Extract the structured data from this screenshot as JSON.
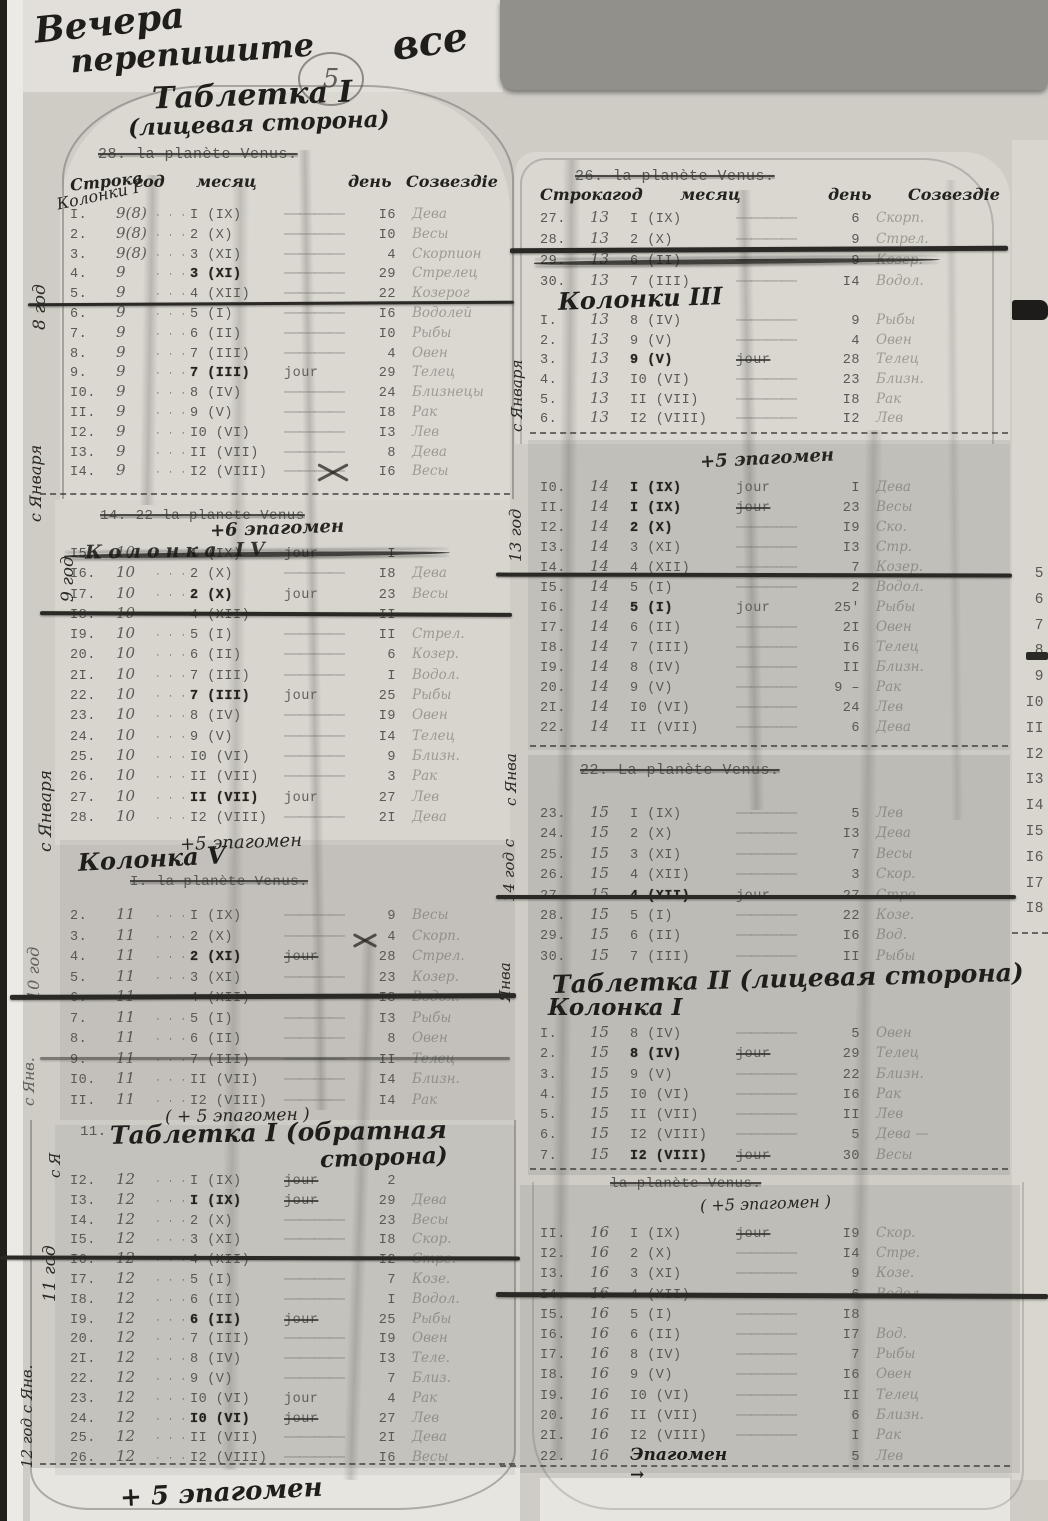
{
  "misc": {
    "dots": "· · ·",
    "dash": "――――",
    "jour": "jour"
  },
  "annotations": {
    "top_scribble_1": "Вечера",
    "top_scribble_2": "перепишите",
    "top_scribble_3": "все",
    "circled_mark": "5",
    "bottom_note": "+ 5 эпагомен"
  },
  "left": {
    "title": "Таблетка I",
    "subtitle": "(лицевая сторона)",
    "t1": {
      "struck_header": "28.      la planète Venus.",
      "headers": {
        "row": "Строка",
        "year": "год",
        "month": "месяц",
        "day": "день",
        "constellation": "Созвездiе"
      },
      "margin_block": "Колонки I",
      "margin_year": "8 год",
      "margin_start": "с Января",
      "rows": [
        {
          "n": "I.",
          "y": "9(8)",
          "m": "I (IX)",
          "d": "I6",
          "c": "Дева"
        },
        {
          "n": "2.",
          "y": "9(8)",
          "m": "2 (X)",
          "d": "I0",
          "c": "Весы"
        },
        {
          "n": "3.",
          "y": "9(8)",
          "m": "3 (XI)",
          "d": "4",
          "c": "Скорпион"
        },
        {
          "n": "4.",
          "y": "9",
          "m": "3 (XI)",
          "b": 1,
          "d": "29",
          "c": "Стрелец"
        },
        {
          "n": "5.",
          "y": "9",
          "m": "4 (XII)",
          "d": "22",
          "c": "Козерог"
        },
        {
          "n": "6.",
          "y": "9",
          "m": "5 (I)",
          "d": "I6",
          "c": "Водолей"
        },
        {
          "n": "7.",
          "y": "9",
          "m": "6 (II)",
          "d": "I0",
          "c": "Рыбы"
        },
        {
          "n": "8.",
          "y": "9",
          "m": "7 (III)",
          "d": "4",
          "c": "Овен"
        },
        {
          "n": "9.",
          "y": "9",
          "m": "7 (III)",
          "b": 1,
          "j": "j",
          "d": "29",
          "c": "Телец"
        },
        {
          "n": "I0.",
          "y": "9",
          "m": "8 (IV)",
          "d": "24",
          "c": "Близнецы"
        },
        {
          "n": "II.",
          "y": "9",
          "m": "9 (V)",
          "d": "I8",
          "c": "Рак"
        },
        {
          "n": "I2.",
          "y": "9",
          "m": "I0 (VI)",
          "d": "I3",
          "c": "Лев"
        },
        {
          "n": "I3.",
          "y": "9",
          "m": "II (VII)",
          "d": "8",
          "c": "Дева"
        },
        {
          "n": "I4.",
          "y": "9",
          "m": "I2 (VIII)",
          "d": "I6",
          "c": "Весы"
        }
      ]
    },
    "t2": {
      "struck_header": "14.  22  la planete Venus",
      "note": "+6 эпагомен",
      "row15_overwrite": "Колонка IV",
      "margin_year": "9 год",
      "margin_start": "с Января",
      "footer": "+5 эпагомен",
      "rows": [
        {
          "n": "I5.",
          "y": "10",
          "m": "I (IX)",
          "j": "j",
          "d": "I",
          "s": 1,
          "c": ""
        },
        {
          "n": "I6.",
          "y": "10",
          "m": "2 (X)",
          "d": "I8",
          "c": "Дева"
        },
        {
          "n": "I7.",
          "y": "10",
          "m": "2 (X)",
          "b": 1,
          "j": "j",
          "d": "23",
          "c": "Весы"
        },
        {
          "n": "I8.",
          "y": "10",
          "m": "4 (XII)",
          "d": "II",
          "c": ""
        },
        {
          "n": "I9.",
          "y": "10",
          "m": "5 (I)",
          "d": "II",
          "c": "Стрел."
        },
        {
          "n": "20.",
          "y": "10",
          "m": "6 (II)",
          "d": "6",
          "c": "Козер."
        },
        {
          "n": "2I.",
          "y": "10",
          "m": "7 (III)",
          "d": "I",
          "c": "Водол."
        },
        {
          "n": "22.",
          "y": "10",
          "m": "7 (III)",
          "b": 1,
          "j": "j",
          "d": "25",
          "c": "Рыбы"
        },
        {
          "n": "23.",
          "y": "10",
          "m": "8 (IV)",
          "d": "I9",
          "c": "Овен"
        },
        {
          "n": "24.",
          "y": "10",
          "m": "9 (V)",
          "d": "I4",
          "c": "Телец"
        },
        {
          "n": "25.",
          "y": "10",
          "m": "I0 (VI)",
          "d": "9",
          "c": "Близн."
        },
        {
          "n": "26.",
          "y": "10",
          "m": "II (VII)",
          "d": "3",
          "c": "Рак"
        },
        {
          "n": "27.",
          "y": "10",
          "m": "II (VII)",
          "b": 1,
          "j": "j",
          "d": "27",
          "c": "Лев"
        },
        {
          "n": "28.",
          "y": "10",
          "m": "I2 (VIII)",
          "d": "2I",
          "c": "Дева"
        }
      ]
    },
    "t3": {
      "heading": "Колонка V",
      "struck_header": "I.      la planète Venus.",
      "margin_year": "10 год",
      "margin_start": "с Янв.",
      "footer": "( + 5 эпагомен )",
      "rows": [
        {
          "n": "2.",
          "y": "11",
          "m": "I (IX)",
          "d": "9",
          "c": "Весы"
        },
        {
          "n": "3.",
          "y": "11",
          "m": "2 (X)",
          "d": "4",
          "c": "Скорп."
        },
        {
          "n": "4.",
          "y": "11",
          "m": "2 (XI)",
          "b": 1,
          "j": "js",
          "d": "28",
          "c": "Стрел."
        },
        {
          "n": "5.",
          "y": "11",
          "m": "3 (XI)",
          "d": "23",
          "c": "Козер."
        },
        {
          "n": "6.",
          "y": "11",
          "m": "4 (XII)",
          "d": "I8",
          "c": "Водол."
        },
        {
          "n": "7.",
          "y": "11",
          "m": "5 (I)",
          "d": "I3",
          "c": "Рыбы"
        },
        {
          "n": "8.",
          "y": "11",
          "m": "6 (II)",
          "d": "8",
          "c": "Овен"
        },
        {
          "n": "9.",
          "y": "11",
          "m": "7 (III)",
          "d": "II",
          "c": "Телец"
        },
        {
          "n": "I0.",
          "y": "11",
          "m": "II (VII)",
          "d": "I4",
          "c": "Близн."
        },
        {
          "n": "II.",
          "y": "11",
          "m": "I2 (VIII)",
          "d": "I4",
          "c": "Рак"
        }
      ]
    },
    "t4": {
      "heading_num": "11.",
      "heading": "Таблетка I (обратная",
      "heading2": "сторона)",
      "margin_year": "11 год",
      "margin_start": "с Я",
      "margin2": "12 год с Янв.",
      "rows": [
        {
          "n": "I2.",
          "y": "12",
          "m": "I (IX)",
          "j": "js",
          "d": "2",
          "c": ""
        },
        {
          "n": "I3.",
          "y": "12",
          "m": "I (IX)",
          "b": 1,
          "j": "js",
          "d": "29",
          "c": "Дева"
        },
        {
          "n": "I4.",
          "y": "12",
          "m": "2 (X)",
          "d": "23",
          "c": "Весы"
        },
        {
          "n": "I5.",
          "y": "12",
          "m": "3 (XI)",
          "d": "I8",
          "c": "Скор."
        },
        {
          "n": "I6.",
          "y": "12",
          "m": "4 (XII)",
          "d": "I2",
          "c": "Стре."
        },
        {
          "n": "I7.",
          "y": "12",
          "m": "5 (I)",
          "d": "7",
          "c": "Козе."
        },
        {
          "n": "I8.",
          "y": "12",
          "m": "6 (II)",
          "d": "I",
          "c": "Водол."
        },
        {
          "n": "I9.",
          "y": "12",
          "m": "6 (II)",
          "b": 1,
          "j": "js",
          "d": "25",
          "c": "Рыбы"
        },
        {
          "n": "20.",
          "y": "12",
          "m": "7 (III)",
          "d": "I9",
          "c": "Овен"
        },
        {
          "n": "2I.",
          "y": "12",
          "m": "8 (IV)",
          "d": "I3",
          "c": "Теле."
        },
        {
          "n": "22.",
          "y": "12",
          "m": "9 (V)",
          "d": "7",
          "c": "Близ."
        },
        {
          "n": "23.",
          "y": "12",
          "m": "I0 (VI)",
          "j": "j",
          "d": "4",
          "c": "Рак"
        },
        {
          "n": "24.",
          "y": "12",
          "m": "I0 (VI)",
          "b": 1,
          "j": "js",
          "d": "27",
          "c": "Лев"
        },
        {
          "n": "25.",
          "y": "12",
          "m": "II (VII)",
          "d": "2I",
          "c": "Дева"
        },
        {
          "n": "26.",
          "y": "12",
          "m": "I2 (VIII)",
          "d": "I6",
          "c": "Весы"
        }
      ]
    }
  },
  "right": {
    "t1": {
      "struck_header": "26.      la planète Venus.",
      "headers": {
        "row": "Строка",
        "year": "год",
        "month": "месяц",
        "day": "день",
        "constellation": "Созвездiе"
      },
      "heading": "Колонки III",
      "margin_start": "с Января",
      "rows_a": [
        {
          "n": "27.",
          "y": "13",
          "m": "I (IX)",
          "d": "6",
          "c": "Скорп."
        },
        {
          "n": "28.",
          "y": "13",
          "m": "2 (X)",
          "d": "9",
          "c": "Стрел."
        },
        {
          "n": "29.",
          "y": "13",
          "m": "6 (II)",
          "d": "9",
          "s": 1,
          "c": "Козер."
        },
        {
          "n": "30.",
          "y": "13",
          "m": "7 (III)",
          "d": "I4",
          "c": "Водол."
        }
      ],
      "rows_b": [
        {
          "n": "I.",
          "y": "13",
          "m": "8 (IV)",
          "d": "9",
          "c": "Рыбы"
        },
        {
          "n": "2.",
          "y": "13",
          "m": "9 (V)",
          "d": "4",
          "c": "Овен"
        },
        {
          "n": "3.",
          "y": "13",
          "m": "9 (V)",
          "b": 1,
          "j": "js",
          "d": "28",
          "c": "Телец"
        },
        {
          "n": "4.",
          "y": "13",
          "m": "I0 (VI)",
          "d": "23",
          "c": "Близн."
        },
        {
          "n": "5.",
          "y": "13",
          "m": "II (VII)",
          "d": "I8",
          "c": "Рак"
        },
        {
          "n": "6.",
          "y": "13",
          "m": "I2 (VIII)",
          "d": "I2",
          "c": "Лев"
        }
      ]
    },
    "t2": {
      "note": "+5 эпагомен",
      "margin_year": "13 год",
      "margin_start": "с Янва",
      "rows": [
        {
          "n": "I0.",
          "y": "14",
          "m": "I (IX)",
          "b": 1,
          "j": "j",
          "d": "I",
          "c": "Дева"
        },
        {
          "n": "II.",
          "y": "14",
          "m": "I (IX)",
          "b": 1,
          "j": "js",
          "d": "23",
          "c": "Весы"
        },
        {
          "n": "I2.",
          "y": "14",
          "m": "2 (X)",
          "b": 1,
          "d": "I9",
          "c": "Ско."
        },
        {
          "n": "I3.",
          "y": "14",
          "m": "3 (XI)",
          "d": "I3",
          "c": "Стр."
        },
        {
          "n": "I4.",
          "y": "14",
          "m": "4 (XII)",
          "d": "7",
          "c": "Козер."
        },
        {
          "n": "I5.",
          "y": "14",
          "m": "5 (I)",
          "d": "2",
          "c": "Водол."
        },
        {
          "n": "I6.",
          "y": "14",
          "m": "5 (I)",
          "b": 1,
          "j": "j",
          "d": "25'",
          "c": "Рыбы"
        },
        {
          "n": "I7.",
          "y": "14",
          "m": "6 (II)",
          "d": "2I",
          "c": "Овен"
        },
        {
          "n": "I8.",
          "y": "14",
          "m": "7 (III)",
          "d": "I6",
          "c": "Телец"
        },
        {
          "n": "I9.",
          "y": "14",
          "m": "8 (IV)",
          "d": "II",
          "c": "Близн."
        },
        {
          "n": "20.",
          "y": "14",
          "m": "9 (V)",
          "d": "9 –",
          "c": "Рак"
        },
        {
          "n": "2I.",
          "y": "14",
          "m": "I0 (VI)",
          "d": "24",
          "c": "Лев"
        },
        {
          "n": "22.",
          "y": "14",
          "m": "II (VII)",
          "d": "6",
          "c": "Дева"
        }
      ]
    },
    "t3": {
      "struck_header": "22.      La planète Venus.",
      "title": "Таблетка II (лицевая сторона)",
      "subtitle": "Колонка I",
      "struck_footer": "la planète Venus.",
      "note": "( +5 эпагомен )",
      "margin_year": "14 год с",
      "margin_start": "Янва",
      "rows_a": [
        {
          "n": "23.",
          "y": "15",
          "m": "I (IX)",
          "d": "5",
          "c": "Лев"
        },
        {
          "n": "24.",
          "y": "15",
          "m": "2 (X)",
          "d": "I3",
          "c": "Дева"
        },
        {
          "n": "25.",
          "y": "15",
          "m": "3 (XI)",
          "d": "7",
          "c": "Весы"
        },
        {
          "n": "26.",
          "y": "15",
          "m": "4 (XII)",
          "d": "3",
          "c": "Скор."
        },
        {
          "n": "27.",
          "y": "15",
          "m": "4 (XII)",
          "b": 1,
          "j": "js",
          "d": "27",
          "c": "Стре."
        },
        {
          "n": "28.",
          "y": "15",
          "m": "5 (I)",
          "d": "22",
          "c": "Козе."
        },
        {
          "n": "29.",
          "y": "15",
          "m": "6 (II)",
          "d": "I6",
          "c": "Вод."
        },
        {
          "n": "30.",
          "y": "15",
          "m": "7 (III)",
          "d": "II",
          "c": "Рыбы"
        }
      ],
      "rows_b": [
        {
          "n": "I.",
          "y": "15",
          "m": "8 (IV)",
          "d": "5",
          "c": "Овен"
        },
        {
          "n": "2.",
          "y": "15",
          "m": "8 (IV)",
          "b": 1,
          "j": "js",
          "d": "29",
          "c": "Телец"
        },
        {
          "n": "3.",
          "y": "15",
          "m": "9 (V)",
          "d": "22",
          "c": "Близн."
        },
        {
          "n": "4.",
          "y": "15",
          "m": "I0 (VI)",
          "d": "I6",
          "c": "Рак"
        },
        {
          "n": "5.",
          "y": "15",
          "m": "II (VII)",
          "d": "II",
          "c": "Лев"
        },
        {
          "n": "6.",
          "y": "15",
          "m": "I2 (VIII)",
          "d": "5",
          "c": "Дева —"
        },
        {
          "n": "7.",
          "y": "15",
          "m": "I2 (VIII)",
          "b": 1,
          "j": "js",
          "d": "30",
          "c": "Весы"
        }
      ]
    },
    "t4": {
      "rows": [
        {
          "n": "II.",
          "y": "16",
          "m": "I (IX)",
          "j": "js",
          "d": "I9",
          "c": "Скор."
        },
        {
          "n": "I2.",
          "y": "16",
          "m": "2 (X)",
          "d": "I4",
          "c": "Стре."
        },
        {
          "n": "I3.",
          "y": "16",
          "m": "3 (XI)",
          "d": "9",
          "c": "Козе."
        },
        {
          "n": "I4.",
          "y": "16",
          "m": "4 (XII)",
          "d": "6",
          "c": "Водол."
        },
        {
          "n": "I5.",
          "y": "16",
          "m": "5 (I)",
          "d": "I8",
          "c": ""
        },
        {
          "n": "I6.",
          "y": "16",
          "m": "6 (II)",
          "d": "I7",
          "c": "Вод."
        },
        {
          "n": "I7.",
          "y": "16",
          "m": "8 (IV)",
          "d": "7",
          "c": "Рыбы"
        },
        {
          "n": "I8.",
          "y": "16",
          "m": "9 (V)",
          "d": "I6",
          "c": "Овен"
        },
        {
          "n": "I9.",
          "y": "16",
          "m": "I0 (VI)",
          "d": "II",
          "c": "Телец"
        },
        {
          "n": "20.",
          "y": "16",
          "m": "II (VII)",
          "d": "6",
          "c": "Близн."
        },
        {
          "n": "2I.",
          "y": "16",
          "m": "I2 (VIII)",
          "d": "I",
          "c": "Рак"
        },
        {
          "n": "22.",
          "y": "16",
          "mh": 1,
          "m": "Эпагомен →",
          "nd": 1,
          "d": "5",
          "c": "Лев"
        }
      ]
    }
  },
  "side_strip": {
    "numbers": [
      "5",
      "6",
      "7",
      "8",
      "9",
      "I0",
      "II",
      "I2",
      "I3",
      "I4",
      "I5",
      "I6",
      "I7",
      "I8"
    ]
  }
}
